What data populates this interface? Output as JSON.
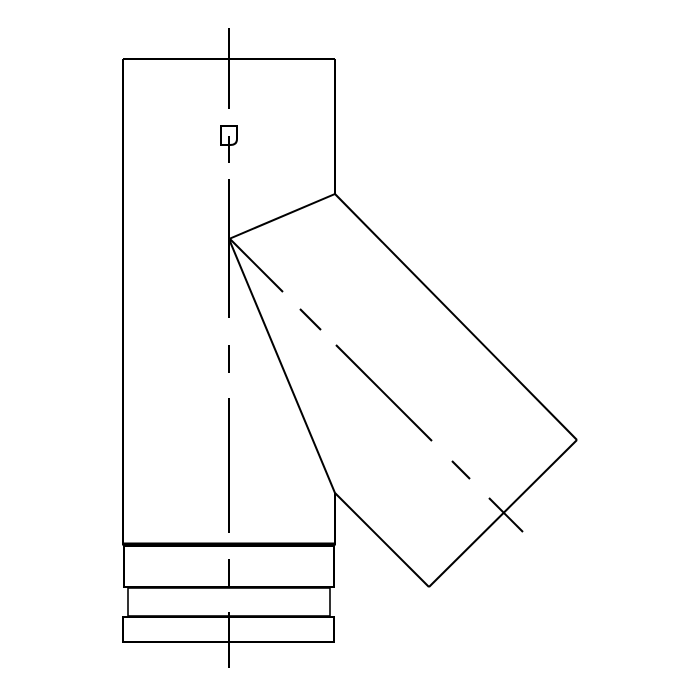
{
  "app": {
    "background_color": "#ffffff",
    "line_color": "#000000"
  },
  "drawing": {
    "name": "45-degree-lateral-tee-pipe-fitting",
    "width": 700,
    "height": 700,
    "solid_lines": [
      {
        "name": "pipe-body-top-edge",
        "pts": [
          123,
          59,
          335,
          59
        ],
        "w": 2
      },
      {
        "name": "pipe-body-left-edge",
        "pts": [
          123,
          59,
          123,
          544
        ],
        "w": 2
      },
      {
        "name": "pipe-body-bottom-edge",
        "pts": [
          122,
          544,
          336,
          544
        ],
        "w": 3
      },
      {
        "name": "pipe-body-right-edge-upper",
        "pts": [
          335,
          59,
          335,
          194
        ],
        "w": 2
      },
      {
        "name": "pipe-body-right-edge-lower",
        "pts": [
          335,
          493,
          335,
          544
        ],
        "w": 2
      },
      {
        "name": "branch-miter-line-upper",
        "pts": [
          229,
          239,
          335,
          194
        ],
        "w": 2
      },
      {
        "name": "branch-top-edge",
        "pts": [
          335,
          194,
          577,
          440
        ],
        "w": 2
      },
      {
        "name": "branch-end-cap-edge",
        "pts": [
          577,
          440,
          429,
          587
        ],
        "w": 2
      },
      {
        "name": "branch-bottom-edge",
        "pts": [
          429,
          587,
          335,
          493
        ],
        "w": 2
      },
      {
        "name": "branch-intersection-line-lower",
        "pts": [
          335,
          493,
          229,
          239
        ],
        "w": 2
      }
    ],
    "rects": [
      {
        "name": "socket-band-upper",
        "x": 124,
        "y": 546,
        "w": 210,
        "h": 41,
        "sw": 2
      },
      {
        "name": "socket-band-middle",
        "x": 128,
        "y": 588,
        "w": 202,
        "h": 28,
        "sw": 1.6
      },
      {
        "name": "socket-band-lower",
        "x": 123,
        "y": 617,
        "w": 211,
        "h": 25,
        "sw": 2
      }
    ],
    "paths": [
      {
        "name": "clip-lock-detail",
        "d": "M 221 126 L 237 126 L 237 139 Q 237 145 230 145 L 221 145 Z",
        "sw": 2
      }
    ],
    "centerlines": [
      {
        "name": "vertical-axis-centerline",
        "w": 2,
        "segments": [
          [
            229,
            28,
            229,
            109
          ],
          [
            229,
            136,
            229,
            163
          ],
          [
            229,
            179,
            229,
            318
          ],
          [
            229,
            345,
            229,
            373
          ],
          [
            229,
            398,
            229,
            533
          ],
          [
            229,
            559,
            229,
            586
          ],
          [
            229,
            612,
            229,
            668
          ]
        ]
      },
      {
        "name": "branch-axis-centerline",
        "w": 2,
        "segments": [
          [
            230,
            239,
            283,
            292
          ],
          [
            300,
            309,
            321,
            330
          ],
          [
            336,
            345,
            432,
            441
          ],
          [
            452,
            461,
            470,
            479
          ],
          [
            489,
            498,
            523,
            532
          ]
        ]
      }
    ]
  }
}
